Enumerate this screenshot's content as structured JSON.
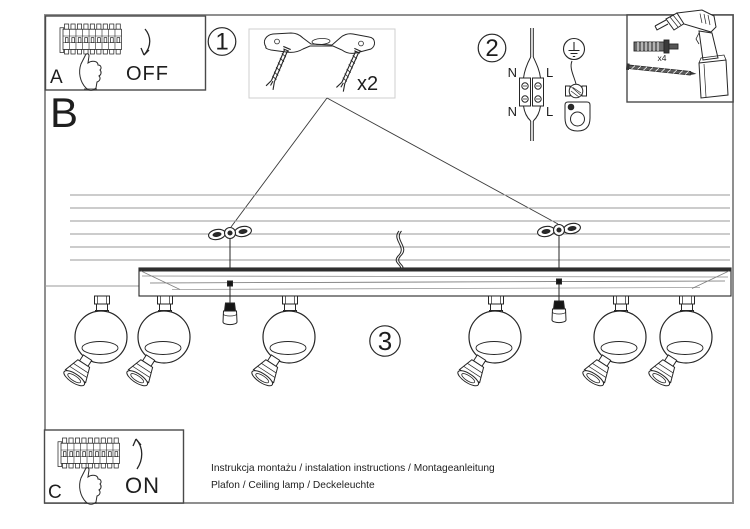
{
  "doc": {
    "step_a_label": "A",
    "step_b_label": "B",
    "step_c_label": "C",
    "step_1_label": "1",
    "step_2_label": "2",
    "step_3_label": "3",
    "off_label": "OFF",
    "on_label": "ON",
    "bracket_qty": "x2",
    "anchor_qty": "x4",
    "wire_n_top": "N",
    "wire_l_top": "L",
    "wire_n_bottom": "N",
    "wire_l_bottom": "L",
    "footer_line1": "Instrukcja montażu / instalation instructions / Montageanleitung",
    "footer_line2": "Plafon / Ceiling lamp / Deckeleuchte"
  },
  "colors": {
    "ink": "#262626",
    "frame": "#8f8f8f",
    "ceiling_line": "#9a9a9a",
    "parts_box_border": "#cfcfcf"
  }
}
